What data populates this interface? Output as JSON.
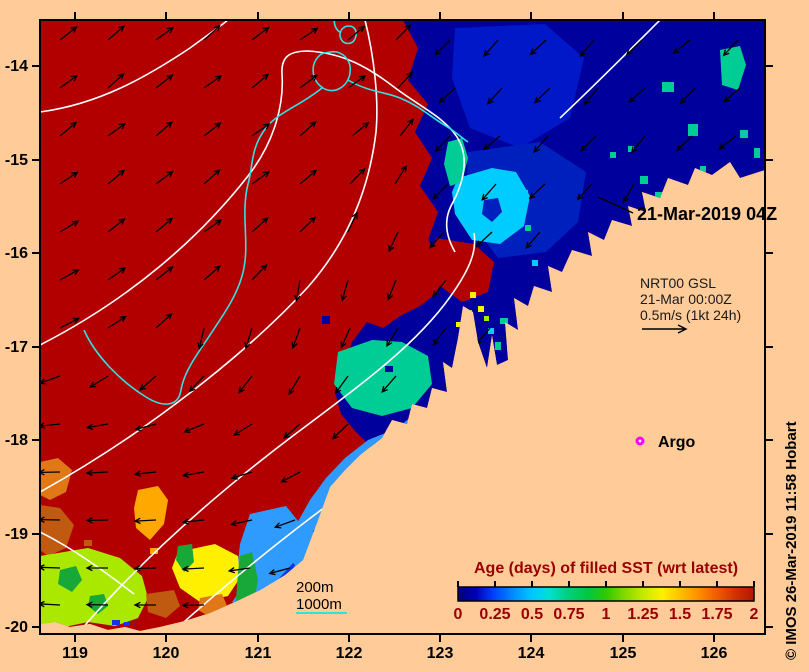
{
  "annotations": {
    "date_label": "21-Mar-2019 04Z",
    "nrt_line1": "NRT00 GSL",
    "nrt_line2": "21-Mar 00:00Z",
    "nrt_line3": "0.5m/s (1kt 24h)",
    "argo_label": "Argo",
    "contour_label_200": "200m",
    "contour_label_1000": "1000m",
    "credit": "© IMOS 26-Mar-2019 11:58 Hobart"
  },
  "axes": {
    "x_tick_labels": [
      "119",
      "120",
      "121",
      "122",
      "123",
      "124",
      "125",
      "126"
    ],
    "y_tick_labels": [
      "-14",
      "-15",
      "-16",
      "-17",
      "-18",
      "-19",
      "-20"
    ]
  },
  "colorbar": {
    "title": "Age (days) of filled SST (wrt latest)",
    "tick_labels": [
      "0",
      "0.25",
      "0.5",
      "0.75",
      "1",
      "1.25",
      "1.5",
      "1.75",
      "2"
    ],
    "label_color": "#990000",
    "stops": [
      [
        0,
        "#000080"
      ],
      [
        0.06,
        "#0000B4"
      ],
      [
        0.12,
        "#0040FF"
      ],
      [
        0.19,
        "#0090FF"
      ],
      [
        0.25,
        "#00C8FF"
      ],
      [
        0.31,
        "#00E0D0"
      ],
      [
        0.37,
        "#00D080"
      ],
      [
        0.44,
        "#00C840"
      ],
      [
        0.5,
        "#30C800"
      ],
      [
        0.56,
        "#80D800"
      ],
      [
        0.62,
        "#C0E800"
      ],
      [
        0.69,
        "#FFF000"
      ],
      [
        0.75,
        "#FFC000"
      ],
      [
        0.81,
        "#FF9000"
      ],
      [
        0.87,
        "#F06000"
      ],
      [
        0.94,
        "#D03000"
      ],
      [
        1,
        "#B01800"
      ]
    ]
  },
  "chart_data": {
    "type": "heatmap",
    "title": "Age (days) of filled SST (wrt latest)",
    "xlabel": "longitude (deg E)",
    "ylabel": "latitude (deg S)",
    "x_ticks": [
      119,
      120,
      121,
      122,
      123,
      124,
      125,
      126
    ],
    "y_ticks": [
      -14,
      -15,
      -16,
      -17,
      -18,
      -19,
      -20
    ],
    "colorbar_range": [
      0,
      2
    ],
    "colorbar_ticks": [
      0,
      0.25,
      0.5,
      0.75,
      1,
      1.25,
      1.5,
      1.75,
      2
    ],
    "legend_position": "bottom-right",
    "annotations": [
      "21-Mar-2019 04Z",
      "NRT00 GSL 21-Mar 00:00Z 0.5m/s (1kt 24h)",
      "Argo",
      "200m",
      "1000m"
    ],
    "summary": "SST data-age map off NW Australia: age~2d (dark red) over most of the open ocean W of ~123E; age 0-0.5d (navy/blue/cyan) along the Kimberley coast NE of a jagged front; patches of 0.5-1.75d (cyan, teal, yellow, orange, chartreuse) along the shelf in the SW; GSL current vectors drawn as black arrows; white 200m and cyan 1000m isobaths"
  },
  "colors": {
    "land": "#FFCC99",
    "red": "#B20000",
    "navy": "#00009C",
    "royal": "#1433E8",
    "medblue": "#0020BE",
    "topblue": "#0018C8",
    "skyblue": "#2F9BFF",
    "cyan": "#00CCFF",
    "teal": "#00CC96",
    "green": "#18A838",
    "chartreuse": "#AAE800",
    "yellow": "#FFF000",
    "orange": "#FFA800",
    "dkorange": "#E07818",
    "brown": "#C05A10",
    "magenta": "#FF00FF",
    "contour_white": "#FFFFFF",
    "contour_cyan": "#33E0E0",
    "frame": "#000000",
    "text": "#000000"
  },
  "map": {
    "frame": [
      40,
      20,
      765,
      634
    ],
    "x_tick_px": [
      75,
      166,
      258,
      349,
      440,
      531,
      623,
      714
    ],
    "y_tick_px": [
      66,
      160,
      253,
      347,
      440,
      534,
      627
    ],
    "ocean": "40,20 765,20 765,170 740,178 730,162 712,175 695,168 688,185 668,178 660,198 642,192 646,212 628,206 632,226 612,220 604,240 588,232 592,256 572,250 562,272 548,266 552,292 534,286 528,306 514,298 518,330 505,322 508,360 497,365 492,335 487,368 478,342 473,312 463,306 458,338 452,368 443,362 447,392 432,388 427,408 412,404 407,424 392,420 382,438 360,455 345,470 330,487 318,520 303,560 285,575 260,590 235,602 210,613 185,621 160,627 140,631 125,627 108,630 90,624 70,627 55,622 40,624",
    "blue_region": "403,20 418,48 408,80 428,104 415,132 432,158 420,186 438,212 428,240 446,264 438,292 420,306 400,316 383,328 367,322 352,342 343,366 335,392 341,414 356,432 372,448 382,438 392,420 407,424 412,404 427,408 432,388 447,392 443,362 452,368 458,338 463,306 473,312 478,342 487,368 492,335 497,365 508,360 505,322 518,330 514,298 528,306 534,286 552,292 548,266 562,272 572,250 592,256 588,232 604,240 612,220 632,226 628,206 646,212 642,192 660,198 668,178 688,185 695,168 712,175 730,162 740,178 765,170 765,20",
    "patches": [
      {
        "c": "topblue",
        "pts": "455,28 545,24 584,58 570,118 520,148 470,128 452,78"
      },
      {
        "c": "medblue",
        "pts": "468,152 540,142 586,172 578,222 546,252 498,258 466,216"
      },
      {
        "c": "cyan",
        "pts": "458,178 492,168 516,172 530,196 524,226 500,244 472,240 455,214 452,192"
      },
      {
        "c": "medblue",
        "pts": "484,200 498,198 502,212 492,222 482,214"
      },
      {
        "c": "teal",
        "pts": "448,142 462,138 468,158 462,182 450,186 444,164"
      },
      {
        "c": "teal",
        "pts": "720,50 740,46 746,65 738,90 722,85"
      },
      {
        "c": "red",
        "pts": "436,238 474,244 494,262 488,292 462,302 440,286 430,260"
      },
      {
        "c": "teal",
        "pts": "338,352 372,340 402,342 428,356 432,384 412,408 382,416 352,408 334,384"
      },
      {
        "c": "skyblue",
        "pts": "398,428 416,412 430,420 422,450 398,472 372,495 350,518 332,545 315,570 295,588 270,600 248,610 232,602 244,585 262,568 280,548 296,525 310,500 326,478 345,458 368,440"
      },
      {
        "c": "royal",
        "pts": "395,435 425,428 438,450 428,478 402,488 388,462"
      },
      {
        "c": "royal",
        "pts": "250,560 280,548 295,565 285,585 258,596 244,580"
      },
      {
        "c": "skyblue",
        "pts": "250,514 286,506 302,526 294,562 272,586 250,600 236,580 240,544"
      },
      {
        "c": "yellow",
        "pts": "178,552 215,544 238,556 240,578 228,596 200,602 180,588 172,568"
      },
      {
        "c": "green",
        "pts": "240,556 252,552 258,580 252,612 243,625 236,600 238,572"
      },
      {
        "c": "green",
        "pts": "178,546 192,544 194,562 184,572 176,560"
      },
      {
        "c": "orange",
        "pts": "138,490 158,486 168,500 164,524 150,540 136,528 134,508"
      },
      {
        "c": "dkorange",
        "pts": "40,462 58,458 72,470 66,492 50,500 40,495"
      },
      {
        "c": "brown",
        "pts": "40,505 60,508 74,525 66,548 48,556 40,550"
      },
      {
        "c": "chartreuse",
        "pts": "40,556 88,548 120,558 142,576 148,598 138,618 115,626 88,622 60,628 40,626"
      },
      {
        "c": "green",
        "pts": "60,570 76,566 82,580 72,592 58,584"
      },
      {
        "c": "green",
        "pts": "90,596 104,594 108,606 98,614 88,606"
      },
      {
        "c": "brown",
        "pts": "146,594 174,590 180,606 166,618 148,612"
      },
      {
        "c": "dkorange",
        "pts": "200,598 222,594 228,608 212,618 198,610"
      }
    ],
    "speckles": [
      [
        688,
        124,
        10,
        12,
        "teal"
      ],
      [
        662,
        82,
        12,
        10,
        "teal"
      ],
      [
        640,
        176,
        8,
        8,
        "teal"
      ],
      [
        655,
        192,
        8,
        8,
        "teal"
      ],
      [
        700,
        166,
        6,
        6,
        "teal"
      ],
      [
        596,
        244,
        8,
        6,
        "teal"
      ],
      [
        610,
        228,
        6,
        8,
        "teal"
      ],
      [
        576,
        260,
        6,
        6,
        "teal"
      ],
      [
        558,
        276,
        8,
        6,
        "teal"
      ],
      [
        544,
        296,
        6,
        6,
        "teal"
      ],
      [
        500,
        318,
        8,
        6,
        "teal"
      ],
      [
        495,
        342,
        6,
        8,
        "teal"
      ],
      [
        525,
        225,
        6,
        6,
        "teal"
      ],
      [
        610,
        152,
        6,
        6,
        "teal"
      ],
      [
        628,
        146,
        6,
        6,
        "teal"
      ],
      [
        740,
        130,
        8,
        8,
        "teal"
      ],
      [
        754,
        148,
        6,
        10,
        "teal"
      ],
      [
        520,
        190,
        8,
        8,
        "cyan"
      ],
      [
        488,
        328,
        6,
        6,
        "cyan"
      ],
      [
        462,
        316,
        6,
        6,
        "cyan"
      ],
      [
        532,
        260,
        6,
        6,
        "cyan"
      ],
      [
        518,
        308,
        6,
        6,
        "red"
      ],
      [
        530,
        330,
        8,
        6,
        "red"
      ],
      [
        544,
        318,
        6,
        6,
        "red"
      ],
      [
        430,
        268,
        8,
        8,
        "red"
      ],
      [
        470,
        292,
        6,
        6,
        "yellow"
      ],
      [
        478,
        306,
        6,
        6,
        "yellow"
      ],
      [
        540,
        302,
        5,
        5,
        "yellow"
      ],
      [
        456,
        322,
        5,
        5,
        "yellow"
      ],
      [
        466,
        310,
        6,
        6,
        "chartreuse"
      ],
      [
        484,
        316,
        5,
        5,
        "chartreuse"
      ],
      [
        370,
        330,
        10,
        8,
        "navy"
      ],
      [
        322,
        316,
        8,
        8,
        "navy"
      ],
      [
        385,
        366,
        8,
        6,
        "navy"
      ],
      [
        112,
        620,
        8,
        5,
        "royal"
      ],
      [
        124,
        622,
        6,
        4,
        "royal"
      ],
      [
        150,
        548,
        8,
        6,
        "orange"
      ],
      [
        84,
        540,
        8,
        6,
        "brown"
      ]
    ],
    "contours_white": [
      "M 40,112 C 100,104 148,76 190,48 C 205,37 218,28 228,20",
      "M 40,345 C 128,300 198,240 248,176 C 276,140 284,102 282,74 C 281,57 289,51 308,51 C 343,53 368,67 394,87 C 419,106 444,117 457,137 C 471,159 462,186 451,206 C 443,222 447,238 455,252",
      "M 40,492 C 148,432 248,352 308,287 C 352,237 370,182 376,132 C 379,99 374,56 365,20",
      "M 74,638 C 138,562 218,492 298,432 C 368,380 418,342 450,297 C 470,269 477,251 474,233",
      "M 166,638 C 238,573 318,509 393,459 C 437,430 467,407 488,378",
      "M 560,118 C 594,86 628,52 660,20",
      "M 40,532 C 74,549 104,571 134,594"
    ],
    "contours_cyan": [
      "M 335,18 C 333,24 336,30 341,33",
      "M 349,26 C 355,26 358,32 355,39 C 352,45 344,45 341,39 C 338,33 342,26 349,26 Z",
      "M 330,52 C 342,50 352,60 350,73 C 348,87 334,95 323,88 C 312,81 310,66 318,57 C 322,52 326,53 330,52 Z",
      "M 322,88 C 300,106 278,112 266,128 C 250,148 253,168 248,184 C 240,216 251,246 242,276 C 236,298 221,318 208,338 C 196,356 184,372 181,390 C 178,408 162,407 146,397 C 120,381 95,355 84,330",
      "M 348,80 C 368,92 386,92 400,98 C 420,106 432,118 446,126 C 456,132 462,138 468,142"
    ],
    "arrows": [
      [
        60,
        40,
        -38
      ],
      [
        108,
        40,
        -41
      ],
      [
        156,
        40,
        -36
      ],
      [
        204,
        40,
        -42
      ],
      [
        252,
        40,
        -37
      ],
      [
        300,
        40,
        -34
      ],
      [
        348,
        40,
        -40
      ],
      [
        396,
        40,
        -46
      ],
      [
        450,
        40,
        135
      ],
      [
        498,
        40,
        131
      ],
      [
        546,
        40,
        137
      ],
      [
        594,
        40,
        130
      ],
      [
        642,
        40,
        136
      ],
      [
        690,
        40,
        141
      ],
      [
        738,
        40,
        133
      ],
      [
        60,
        88,
        -36
      ],
      [
        108,
        88,
        -42
      ],
      [
        156,
        88,
        -38
      ],
      [
        204,
        88,
        -35
      ],
      [
        252,
        88,
        -40
      ],
      [
        300,
        88,
        -37
      ],
      [
        348,
        88,
        -35
      ],
      [
        398,
        88,
        -48
      ],
      [
        455,
        88,
        137
      ],
      [
        502,
        88,
        132
      ],
      [
        550,
        88,
        136
      ],
      [
        598,
        88,
        130
      ],
      [
        645,
        88,
        138
      ],
      [
        695,
        88,
        133
      ],
      [
        740,
        88,
        139
      ],
      [
        60,
        136,
        -40
      ],
      [
        108,
        136,
        -36
      ],
      [
        156,
        136,
        -41
      ],
      [
        204,
        136,
        -38
      ],
      [
        252,
        136,
        -35
      ],
      [
        300,
        136,
        -42
      ],
      [
        352,
        136,
        -39
      ],
      [
        400,
        136,
        -52
      ],
      [
        450,
        136,
        133
      ],
      [
        500,
        136,
        140
      ],
      [
        548,
        136,
        131
      ],
      [
        596,
        136,
        135
      ],
      [
        645,
        136,
        129
      ],
      [
        692,
        136,
        136
      ],
      [
        736,
        136,
        142
      ],
      [
        60,
        184,
        -34
      ],
      [
        108,
        184,
        -40
      ],
      [
        156,
        184,
        -37
      ],
      [
        204,
        184,
        -42
      ],
      [
        252,
        184,
        -36
      ],
      [
        300,
        184,
        -40
      ],
      [
        350,
        184,
        -46
      ],
      [
        395,
        184,
        -58
      ],
      [
        448,
        184,
        135
      ],
      [
        496,
        184,
        131
      ],
      [
        545,
        184,
        137
      ],
      [
        592,
        184,
        133
      ],
      [
        634,
        184,
        120
      ],
      [
        60,
        232,
        -31
      ],
      [
        108,
        232,
        -38
      ],
      [
        156,
        232,
        -40
      ],
      [
        204,
        232,
        -35
      ],
      [
        252,
        232,
        -42
      ],
      [
        300,
        232,
        -44
      ],
      [
        348,
        232,
        -65
      ],
      [
        398,
        232,
        115
      ],
      [
        444,
        232,
        132
      ],
      [
        492,
        232,
        137
      ],
      [
        540,
        232,
        131
      ],
      [
        60,
        280,
        -29
      ],
      [
        108,
        280,
        -35
      ],
      [
        156,
        280,
        -38
      ],
      [
        204,
        280,
        -41
      ],
      [
        252,
        280,
        -46
      ],
      [
        300,
        280,
        100
      ],
      [
        348,
        280,
        106
      ],
      [
        396,
        280,
        112
      ],
      [
        446,
        280,
        128
      ],
      [
        60,
        328,
        -27
      ],
      [
        108,
        328,
        -33
      ],
      [
        156,
        328,
        -42
      ],
      [
        204,
        328,
        103
      ],
      [
        252,
        328,
        107
      ],
      [
        300,
        328,
        110
      ],
      [
        350,
        328,
        114
      ],
      [
        398,
        328,
        122
      ],
      [
        446,
        328,
        127
      ],
      [
        490,
        328,
        130
      ],
      [
        60,
        376,
        160
      ],
      [
        108,
        376,
        148
      ],
      [
        156,
        376,
        139
      ],
      [
        204,
        376,
        133
      ],
      [
        252,
        376,
        128
      ],
      [
        300,
        376,
        121
      ],
      [
        348,
        376,
        126
      ],
      [
        396,
        376,
        131
      ],
      [
        60,
        424,
        174
      ],
      [
        108,
        424,
        170
      ],
      [
        156,
        424,
        165
      ],
      [
        204,
        424,
        158
      ],
      [
        252,
        424,
        148
      ],
      [
        300,
        424,
        139
      ],
      [
        348,
        424,
        136
      ],
      [
        60,
        472,
        179
      ],
      [
        108,
        472,
        177
      ],
      [
        156,
        472,
        174
      ],
      [
        204,
        472,
        170
      ],
      [
        252,
        472,
        163
      ],
      [
        300,
        472,
        152
      ],
      [
        60,
        520,
        181
      ],
      [
        108,
        520,
        179
      ],
      [
        156,
        520,
        177
      ],
      [
        204,
        520,
        174
      ],
      [
        252,
        520,
        168
      ],
      [
        295,
        520,
        160
      ],
      [
        332,
        520,
        148
      ],
      [
        60,
        568,
        182
      ],
      [
        108,
        568,
        180
      ],
      [
        156,
        568,
        179
      ],
      [
        204,
        568,
        177
      ],
      [
        250,
        568,
        172
      ],
      [
        290,
        568,
        165
      ],
      [
        60,
        605,
        183
      ],
      [
        108,
        605,
        181
      ],
      [
        156,
        605,
        180
      ],
      [
        204,
        605,
        179
      ]
    ],
    "pointer_line": [
      633,
      213,
      598,
      197
    ],
    "nrt_arrow": [
      642,
      329,
      686,
      329
    ],
    "argo_marker": [
      640,
      441
    ],
    "legend_cyan_line": [
      296,
      613,
      347,
      613
    ]
  }
}
